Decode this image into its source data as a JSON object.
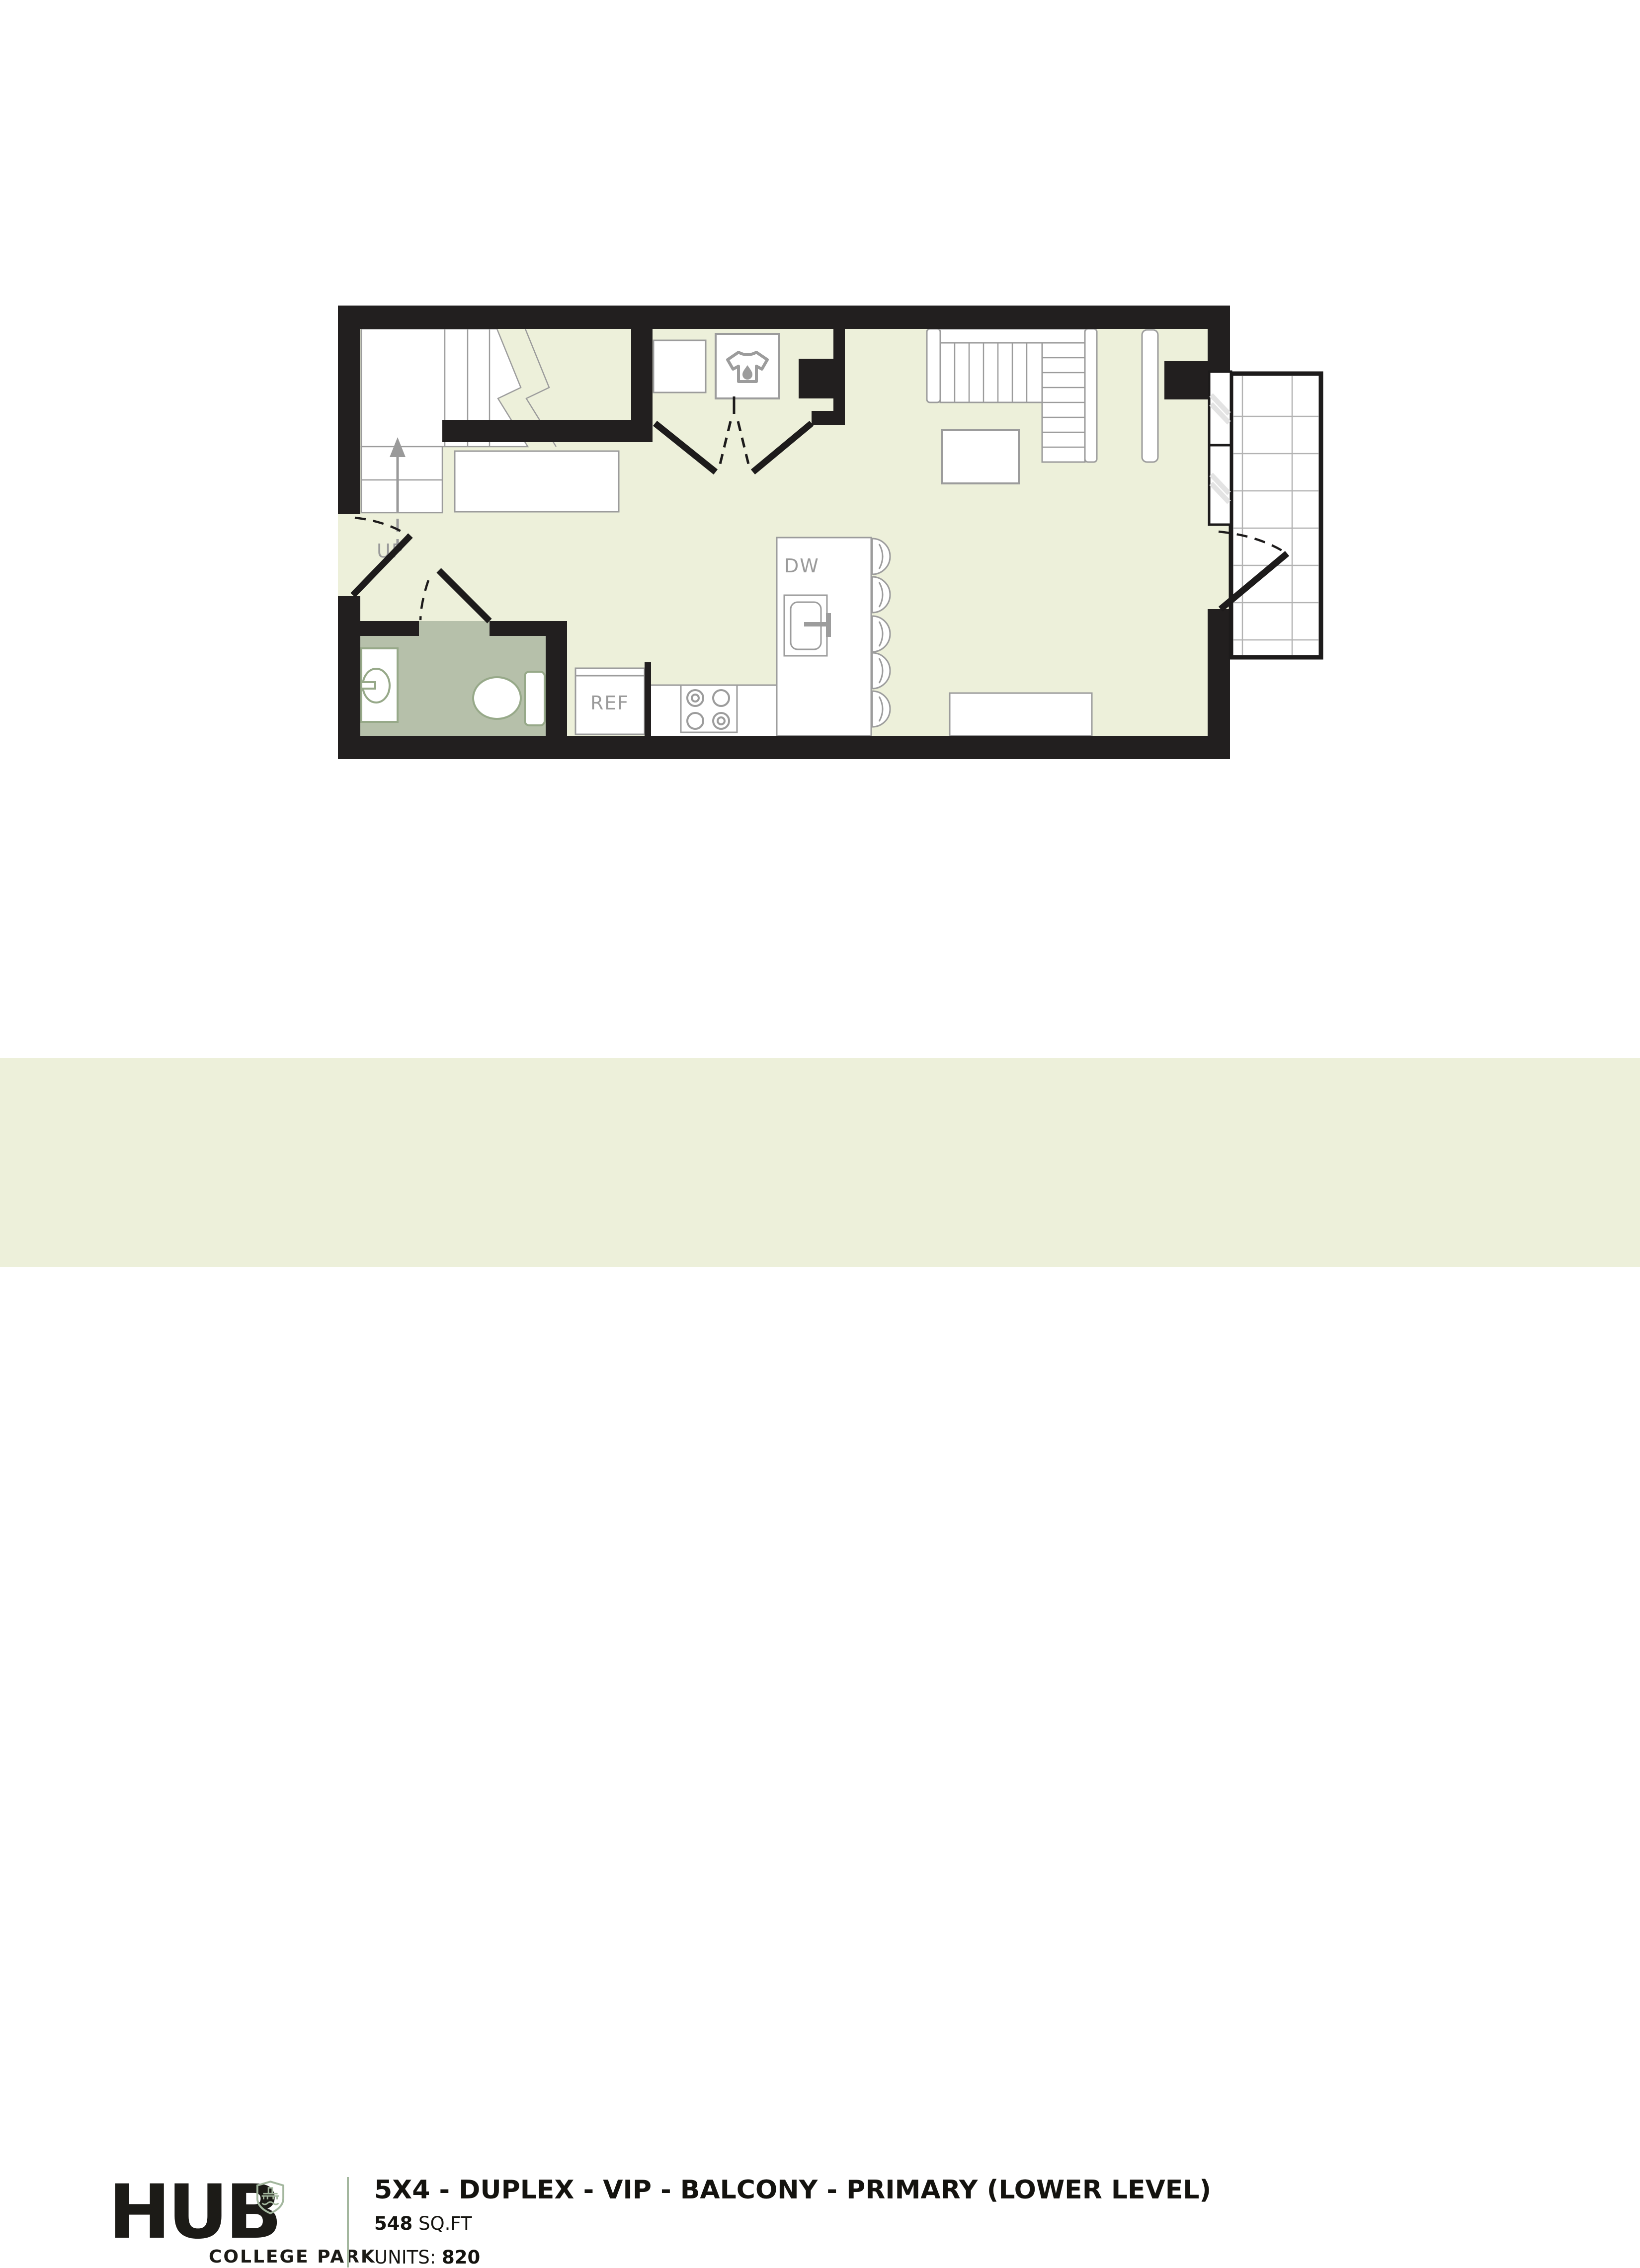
{
  "colors": {
    "wall": "#221f1f",
    "floor": "#edf0da",
    "bathroom_floor": "#b6c0aa",
    "furniture_outline": "#9c9c9c",
    "fixture_outline": "#97a989",
    "label_gray": "#9a9a9a",
    "accent_green": "#a3b79e",
    "text_dark": "#1c1b17",
    "footer_band": "#edf0da",
    "page_background": "#ffffff",
    "balcony_line": "#1d1b1b"
  },
  "floorplan": {
    "labels": {
      "stairs": "UP",
      "dishwasher": "DW",
      "refrigerator": "REF"
    },
    "rooms": [
      "stairwell",
      "laundry closet",
      "bathroom",
      "kitchen",
      "living area",
      "balcony"
    ],
    "features": [
      "stairs up",
      "washer",
      "dryer",
      "bifold closet doors",
      "entry door",
      "bathroom door",
      "balcony door",
      "kitchen island with sink",
      "bar stools",
      "4-burner cooktop",
      "refrigerator",
      "sectional sofa",
      "coffee table",
      "console table",
      "dresser",
      "vanity sink",
      "toilet",
      "windows",
      "tiled balcony"
    ],
    "stool_count": 5,
    "burner_count": 4
  },
  "footer": {
    "logo": {
      "brand": "HUB",
      "sublabel": "COLLEGE PARK"
    },
    "plan": {
      "title": "5X4 - DUPLEX - VIP - BALCONY - PRIMARY (LOWER LEVEL)",
      "area_value": "548",
      "area_unit": " SQ.FT",
      "units_label": "UNITS: ",
      "units_value": "820"
    }
  }
}
